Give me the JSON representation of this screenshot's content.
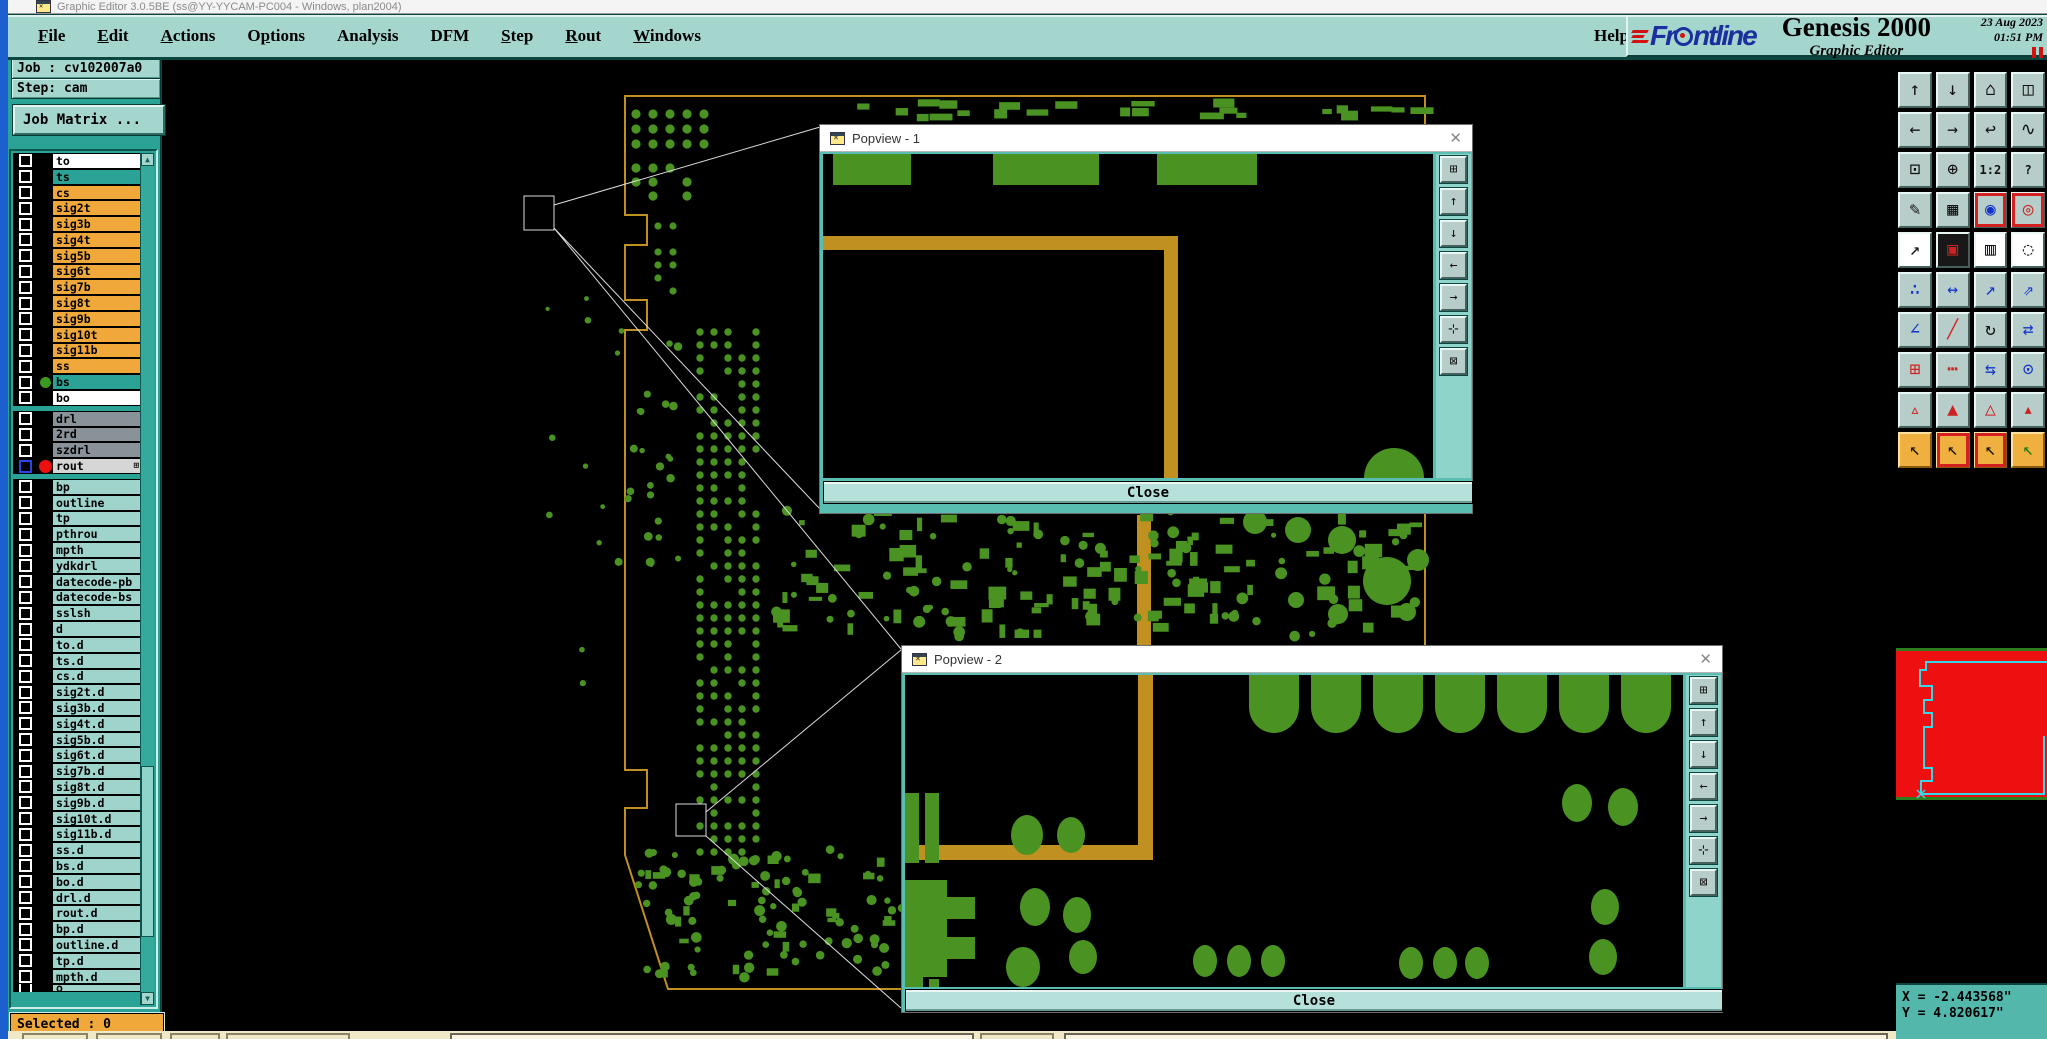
{
  "titlebar": {
    "text": "Graphic Editor 3.0.5BE (ss@YY-YYCAM-PC004 - Windows, plan2004)"
  },
  "menu": {
    "items": [
      {
        "label": "File",
        "u": 0
      },
      {
        "label": "Edit",
        "u": 0
      },
      {
        "label": "Actions",
        "u": 0
      },
      {
        "label": "Options",
        "u": 1
      },
      {
        "label": "Analysis",
        "u": -1
      },
      {
        "label": "DFM",
        "u": -1
      },
      {
        "label": "Step",
        "u": 0
      },
      {
        "label": "Rout",
        "u": 0
      },
      {
        "label": "Windows",
        "u": 0
      }
    ],
    "help": {
      "label": "Help",
      "u": -1
    }
  },
  "brand": {
    "logo_fr": "Fr",
    "logo_ntline": "ntline",
    "product": "Genesis 2000",
    "subtitle": "Graphic Editor",
    "date": "23 Aug 2023",
    "time": "01:51 PM"
  },
  "sidebar": {
    "job": "Job : cv102007a0",
    "step": "Step: cam",
    "job_matrix": "Job Matrix ...",
    "selected": "Selected : 0",
    "layer_groups": [
      {
        "rows": [
          {
            "name": "to",
            "bg": "white"
          },
          {
            "name": "ts",
            "bg": "teal"
          },
          {
            "name": "cs",
            "bg": "orange"
          },
          {
            "name": "sig2t",
            "bg": "orange"
          },
          {
            "name": "sig3b",
            "bg": "orange"
          },
          {
            "name": "sig4t",
            "bg": "orange"
          },
          {
            "name": "sig5b",
            "bg": "orange"
          },
          {
            "name": "sig6t",
            "bg": "orange"
          },
          {
            "name": "sig7b",
            "bg": "orange"
          },
          {
            "name": "sig8t",
            "bg": "orange"
          },
          {
            "name": "sig9b",
            "bg": "orange"
          },
          {
            "name": "sig10t",
            "bg": "orange"
          },
          {
            "name": "sig11b",
            "bg": "orange"
          },
          {
            "name": "ss",
            "bg": "orange"
          },
          {
            "name": "bs",
            "bg": "teal",
            "dot": "green"
          },
          {
            "name": "bo",
            "bg": "white"
          }
        ]
      },
      {
        "rows": [
          {
            "name": "drl",
            "bg": "gray"
          },
          {
            "name": "2rd",
            "bg": "gray"
          },
          {
            "name": "szdrl",
            "bg": "gray"
          },
          {
            "name": "rout",
            "bg": "lightgray",
            "dot": "red",
            "cb": "blue",
            "marker": "⊞"
          }
        ]
      },
      {
        "rows": [
          {
            "name": "bp",
            "bg": "cyan"
          },
          {
            "name": "outline",
            "bg": "cyan"
          },
          {
            "name": "tp",
            "bg": "cyan"
          },
          {
            "name": "pthrou",
            "bg": "cyan"
          },
          {
            "name": "mpth",
            "bg": "cyan"
          },
          {
            "name": "ydkdrl",
            "bg": "cyan"
          },
          {
            "name": "datecode-pb",
            "bg": "cyan"
          },
          {
            "name": "datecode-bs",
            "bg": "cyan"
          },
          {
            "name": "sslsh",
            "bg": "cyan"
          },
          {
            "name": "d",
            "bg": "cyan"
          },
          {
            "name": "to.d",
            "bg": "cyan"
          },
          {
            "name": "ts.d",
            "bg": "cyan"
          },
          {
            "name": "cs.d",
            "bg": "cyan"
          },
          {
            "name": "sig2t.d",
            "bg": "cyan"
          },
          {
            "name": "sig3b.d",
            "bg": "cyan"
          },
          {
            "name": "sig4t.d",
            "bg": "cyan"
          },
          {
            "name": "sig5b.d",
            "bg": "cyan"
          },
          {
            "name": "sig6t.d",
            "bg": "cyan"
          },
          {
            "name": "sig7b.d",
            "bg": "cyan"
          },
          {
            "name": "sig8t.d",
            "bg": "cyan"
          },
          {
            "name": "sig9b.d",
            "bg": "cyan"
          },
          {
            "name": "sig10t.d",
            "bg": "cyan"
          },
          {
            "name": "sig11b.d",
            "bg": "cyan"
          },
          {
            "name": "ss.d",
            "bg": "cyan"
          },
          {
            "name": "bs.d",
            "bg": "cyan"
          },
          {
            "name": "bo.d",
            "bg": "cyan"
          },
          {
            "name": "drl.d",
            "bg": "cyan"
          },
          {
            "name": "rout.d",
            "bg": "cyan"
          },
          {
            "name": "bp.d",
            "bg": "cyan"
          },
          {
            "name": "outline.d",
            "bg": "cyan"
          },
          {
            "name": "tp.d",
            "bg": "cyan"
          },
          {
            "name": "mpth.d",
            "bg": "cyan"
          },
          {
            "name": "o",
            "bg": "cyan",
            "partial": true
          }
        ]
      }
    ]
  },
  "toolbar": {
    "buttons": [
      {
        "name": "zoom-in",
        "g": "↑"
      },
      {
        "name": "zoom-out",
        "g": "↓"
      },
      {
        "name": "home-view",
        "g": "⌂"
      },
      {
        "name": "window-xy",
        "g": "◫"
      },
      {
        "name": "pan-left",
        "g": "←"
      },
      {
        "name": "pan-right",
        "g": "→"
      },
      {
        "name": "previous-view",
        "g": "↩"
      },
      {
        "name": "serpentine-route",
        "g": "∿"
      },
      {
        "name": "fit-view",
        "g": "⊡"
      },
      {
        "name": "center-view",
        "g": "⊕"
      },
      {
        "name": "scale-1-2",
        "g": "1:2",
        "small": true
      },
      {
        "name": "context-help",
        "g": "?",
        "small": true
      },
      {
        "name": "draw-tools",
        "g": "✎"
      },
      {
        "name": "grid-toggle",
        "g": "▦"
      },
      {
        "name": "net-highlight",
        "g": "◉",
        "c": "#1133cc",
        "sel": true
      },
      {
        "name": "net-query",
        "g": "◎",
        "c": "#cc2222",
        "sel": true
      },
      {
        "name": "select-move",
        "g": "↗",
        "bg": "white"
      },
      {
        "name": "transform-shape",
        "g": "▣",
        "bg": "dark",
        "c": "#cc2222"
      },
      {
        "name": "measure-ruler",
        "g": "▥",
        "bg": "white"
      },
      {
        "name": "pad-select",
        "g": "◌",
        "bg": "white"
      },
      {
        "name": "chain-select",
        "g": "∴",
        "c": "#1133cc"
      },
      {
        "name": "pitch-measure",
        "g": "↔",
        "c": "#1133cc"
      },
      {
        "name": "copy-arrow",
        "g": "↗",
        "c": "#1133cc"
      },
      {
        "name": "move-arrow",
        "g": "⇗",
        "c": "#1133cc"
      },
      {
        "name": "angle-measure",
        "g": "∠",
        "c": "#1133cc"
      },
      {
        "name": "slope-line",
        "g": "╱",
        "c": "#cc2222"
      },
      {
        "name": "rotate-arc",
        "g": "↻"
      },
      {
        "name": "mirror-flip",
        "g": "⇄",
        "c": "#1133cc"
      },
      {
        "name": "swap-pad",
        "g": "⊞",
        "c": "#cc2222"
      },
      {
        "name": "break-line",
        "g": "┅",
        "c": "#cc2222"
      },
      {
        "name": "dimension-width",
        "g": "⇆",
        "c": "#1133cc"
      },
      {
        "name": "shape-overlap",
        "g": "⊙",
        "c": "#1133cc"
      },
      {
        "name": "triangle-mark-1",
        "g": "▵",
        "c": "#cc2222"
      },
      {
        "name": "triangle-mark-2",
        "g": "▲",
        "c": "#cc2222"
      },
      {
        "name": "triangle-mark-3",
        "g": "△",
        "c": "#cc2222"
      },
      {
        "name": "triangle-mark-4",
        "g": "▴",
        "c": "#cc2222"
      },
      {
        "name": "cursor-select",
        "g": "↖",
        "bg": "amber"
      },
      {
        "name": "cursor-frame",
        "g": "↖",
        "bg": "amber",
        "sel": true
      },
      {
        "name": "cursor-inside",
        "g": "↖",
        "bg": "amber",
        "sel": true
      },
      {
        "name": "cursor-net",
        "g": "↖",
        "bg": "amber",
        "c": "#1a7a10"
      }
    ]
  },
  "popviews": [
    {
      "title": "Popview - 1",
      "close": "Close"
    },
    {
      "title": "Popview - 2",
      "close": "Close"
    }
  ],
  "popview_tools": [
    {
      "name": "popview-settings",
      "g": "⊞"
    },
    {
      "name": "popview-zoom-in",
      "g": "↑"
    },
    {
      "name": "popview-zoom-out",
      "g": "↓"
    },
    {
      "name": "popview-pan-left",
      "g": "←"
    },
    {
      "name": "popview-pan-right",
      "g": "→"
    },
    {
      "name": "popview-expand",
      "g": "⊹"
    },
    {
      "name": "popview-shrink",
      "g": "⊠"
    }
  ],
  "status": {
    "x": "X = -2.443568\"",
    "y": "Y = 4.820617\""
  },
  "colors": {
    "menu_bg": "#a5d6ce",
    "panel_teal": "#2aa295",
    "row_white": "#ffffff",
    "row_teal": "#2aa295",
    "row_orange": "#f0a83a",
    "row_gray": "#8a9299",
    "row_lightgray": "#d6d6d6",
    "row_cyan": "#9fd4cc",
    "pcb_green": "#4a9322",
    "board_outline_tan": "#c09020",
    "overview_red": "#ee1010",
    "overview_outline_cyan": "#35d8e8",
    "status_bg": "#53b7ab",
    "accent_red": "#d41111",
    "logo_navy": "#1b2f9e",
    "amber": "#f0b040"
  }
}
